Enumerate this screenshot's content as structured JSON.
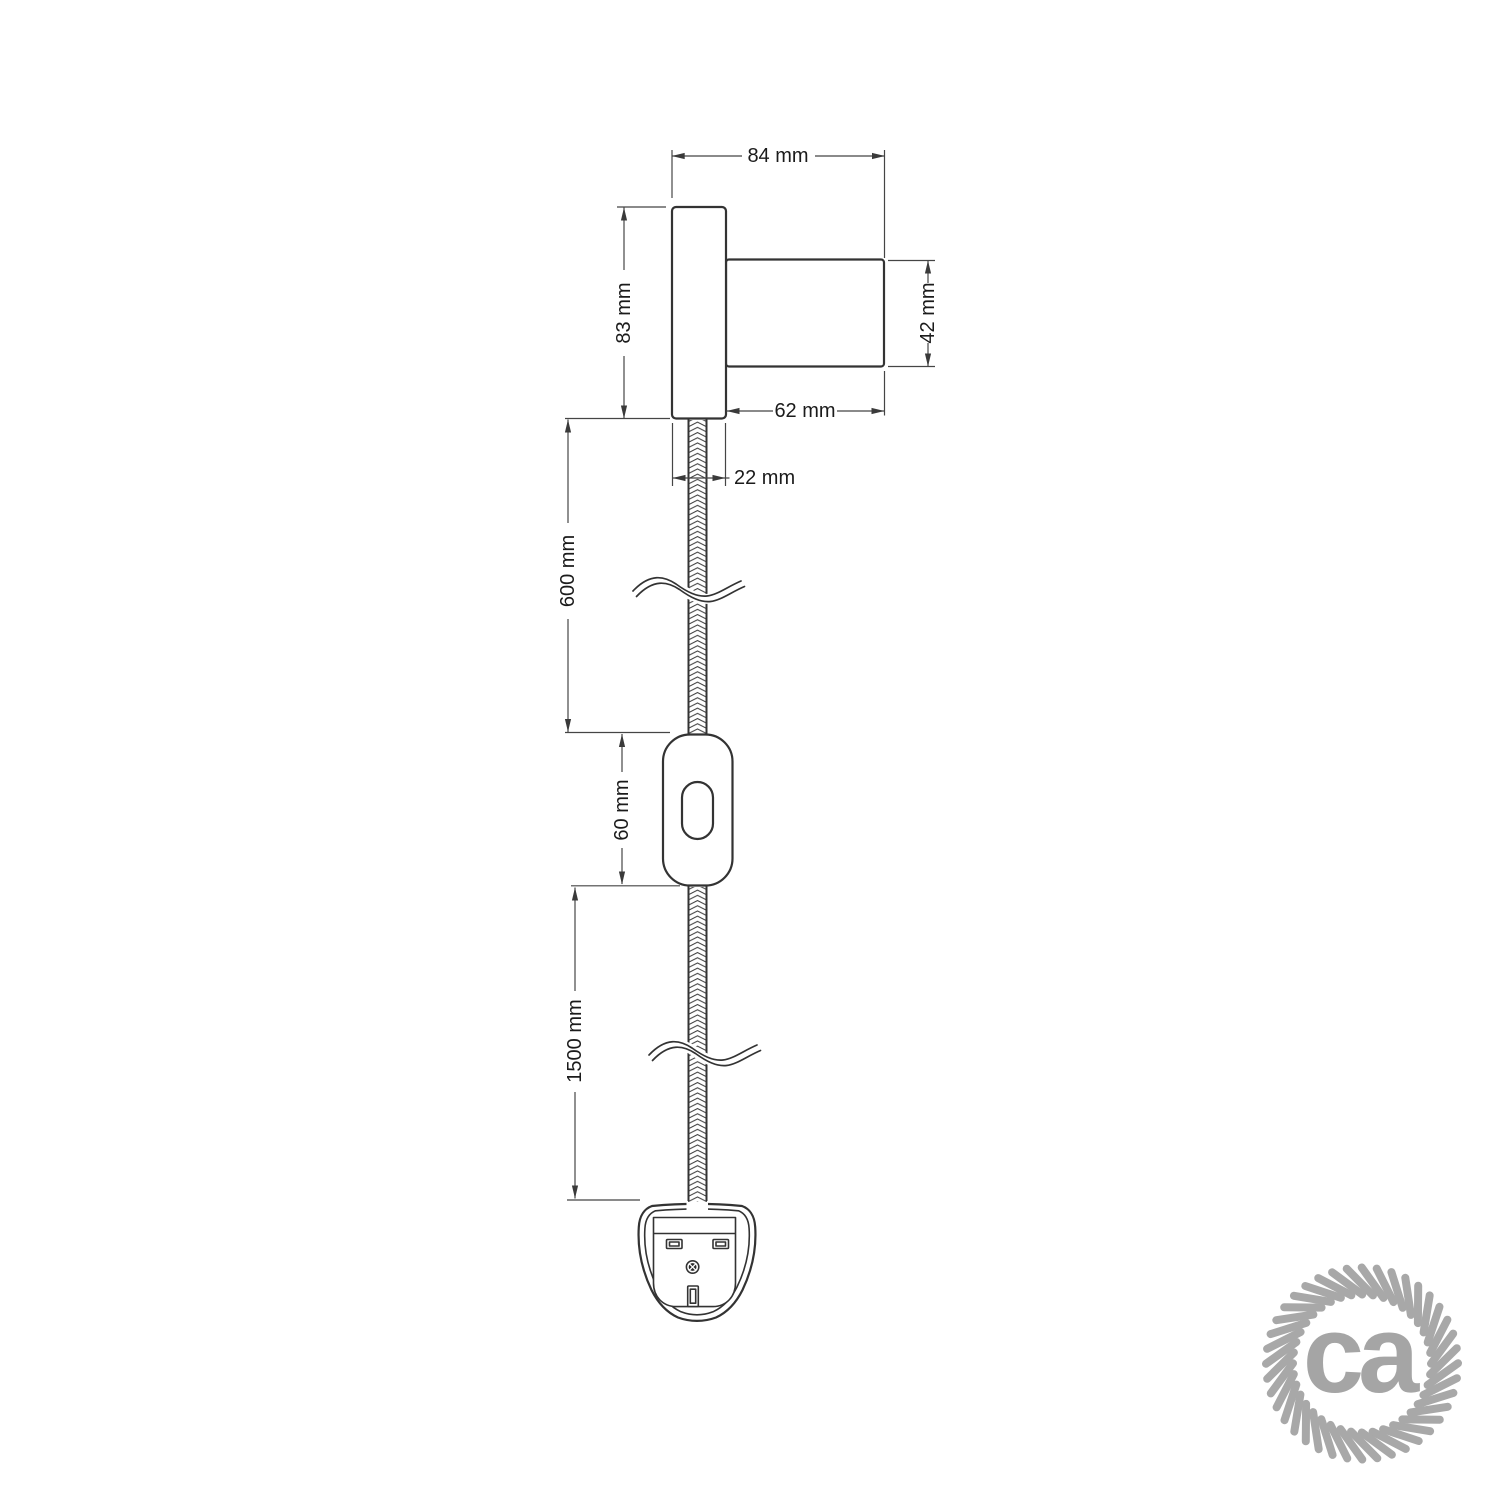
{
  "dimensions": {
    "fixture_total_width": "84 mm",
    "plate_height": "83 mm",
    "holder_diameter": "42 mm",
    "holder_length": "62 mm",
    "plate_thickness": "22 mm",
    "upper_cable_length": "600 mm",
    "switch_length": "60 mm",
    "lower_cable_length": "1500 mm"
  },
  "logo": {
    "text": "ca",
    "icon": "rope-circle-icon"
  },
  "colors": {
    "background": "#ffffff",
    "object_line": "#333333",
    "dimension_line": "#454545",
    "label_text": "#1b1b1b",
    "logo_gray": "#a5a5a5"
  }
}
